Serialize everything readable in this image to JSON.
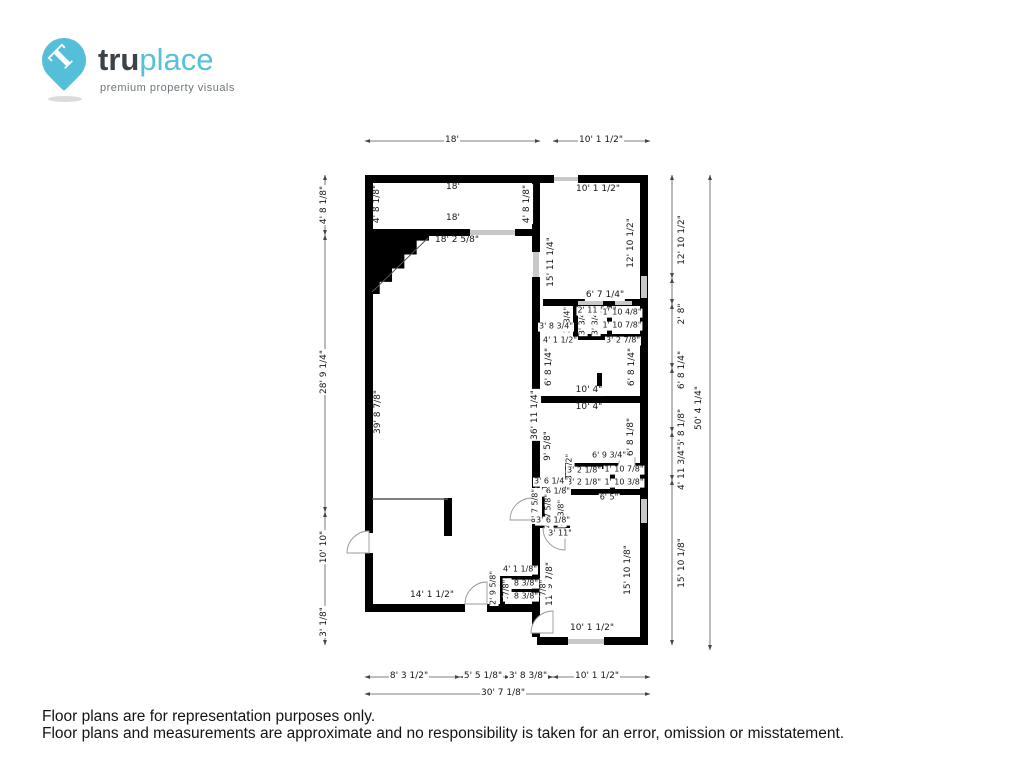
{
  "logo": {
    "brand_prefix": "tru",
    "brand_suffix": "place",
    "tagline": "premium property visuals",
    "pin_glyph": "T"
  },
  "colors": {
    "accent_blue": "#55bed8",
    "brand_dark": "#3b4248",
    "wall_black": "#000000",
    "window_gray": "#c8c8c8",
    "dimension_line": "#555555"
  },
  "footer": {
    "line1": "Floor plans are for representation purposes only.",
    "line2": "Floor plans and measurements are approximate and no responsibility is taken for an error, omission or misstatement."
  },
  "floorplan": {
    "dimension_labels": [
      {
        "text": "18'",
        "x": 452,
        "y": 141,
        "rot": 0,
        "s": 9
      },
      {
        "text": "10' 1 1/2\"",
        "x": 601,
        "y": 141,
        "rot": 0,
        "s": 9
      },
      {
        "text": "4' 8 1/8\"",
        "x": 325,
        "y": 205,
        "rot": -90,
        "s": 9
      },
      {
        "text": "28' 9 1/4\"",
        "x": 325,
        "y": 372,
        "rot": -90,
        "s": 9
      },
      {
        "text": "10' 10\"",
        "x": 325,
        "y": 547,
        "rot": -90,
        "s": 9
      },
      {
        "text": "3' 1/8\"",
        "x": 325,
        "y": 622,
        "rot": -90,
        "s": 9
      },
      {
        "text": "12' 10 1/2\"",
        "x": 683,
        "y": 240,
        "rot": -90,
        "s": 9
      },
      {
        "text": "2' 8\"",
        "x": 683,
        "y": 314,
        "rot": -90,
        "s": 9
      },
      {
        "text": "6' 8 1/4\"",
        "x": 683,
        "y": 370,
        "rot": -90,
        "s": 9
      },
      {
        "text": "6' 8 1/8\"",
        "x": 683,
        "y": 428,
        "rot": -90,
        "s": 9
      },
      {
        "text": "4' 11 3/4\"",
        "x": 683,
        "y": 468,
        "rot": -90,
        "s": 9
      },
      {
        "text": "15' 10 1/8\"",
        "x": 683,
        "y": 563,
        "rot": -90,
        "s": 9
      },
      {
        "text": "50' 4 1/4\"",
        "x": 700,
        "y": 408,
        "rot": -90,
        "s": 9
      },
      {
        "text": "8' 3 1/2\"",
        "x": 409,
        "y": 677,
        "rot": 0,
        "s": 9
      },
      {
        "text": "5' 5 1/8\"",
        "x": 483,
        "y": 677,
        "rot": 0,
        "s": 9
      },
      {
        "text": "3' 8 3/8\"",
        "x": 528,
        "y": 677,
        "rot": 0,
        "s": 9
      },
      {
        "text": "10' 1 1/2\"",
        "x": 597,
        "y": 677,
        "rot": 0,
        "s": 9
      },
      {
        "text": "30' 7 1/8\"",
        "x": 503,
        "y": 694,
        "rot": 0,
        "s": 9
      },
      {
        "text": "18'",
        "x": 453,
        "y": 188,
        "rot": 0,
        "s": 9
      },
      {
        "text": "4' 8 1/8\"",
        "x": 378,
        "y": 204,
        "rot": -90,
        "s": 9
      },
      {
        "text": "4' 8 1/8\"",
        "x": 528,
        "y": 204,
        "rot": -90,
        "s": 9
      },
      {
        "text": "18'",
        "x": 453,
        "y": 219,
        "rot": 0,
        "s": 9
      },
      {
        "text": "18' 2 5/8\"",
        "x": 457,
        "y": 241,
        "rot": 0,
        "s": 9
      },
      {
        "text": "10' 1 1/2\"",
        "x": 598,
        "y": 190,
        "rot": 0,
        "s": 9
      },
      {
        "text": "12' 10 1/2\"",
        "x": 632,
        "y": 243,
        "rot": -90,
        "s": 9
      },
      {
        "text": "15' 11 1/4\"",
        "x": 552,
        "y": 262,
        "rot": -90,
        "s": 9
      },
      {
        "text": "6' 7 1/4\"",
        "x": 605,
        "y": 296,
        "rot": 0,
        "s": 9
      },
      {
        "text": "3' 3/4\"",
        "x": 568,
        "y": 320,
        "rot": -90,
        "s": 8
      },
      {
        "text": "3' 3/4\"",
        "x": 583,
        "y": 322,
        "rot": -90,
        "s": 8
      },
      {
        "text": "3' 3/4\"",
        "x": 596,
        "y": 322,
        "rot": -90,
        "s": 8
      },
      {
        "text": "2' 11 5/8\"",
        "x": 597,
        "y": 311,
        "rot": 0,
        "s": 8
      },
      {
        "text": "1' 10 4/8\"",
        "x": 622,
        "y": 313,
        "rot": 0,
        "s": 8
      },
      {
        "text": "1' 10 7/8\"",
        "x": 622,
        "y": 326,
        "rot": 0,
        "s": 8
      },
      {
        "text": "3' 8 3/4\"",
        "x": 556,
        "y": 327,
        "rot": 0,
        "s": 8
      },
      {
        "text": "4' 1 1/2\"",
        "x": 560,
        "y": 341,
        "rot": 0,
        "s": 8
      },
      {
        "text": "3' 2 7/8\"",
        "x": 623,
        "y": 341,
        "rot": 0,
        "s": 8
      },
      {
        "text": "6' 8 1/4\"",
        "x": 550,
        "y": 367,
        "rot": -90,
        "s": 9
      },
      {
        "text": "6' 8 1/4\"",
        "x": 633,
        "y": 367,
        "rot": -90,
        "s": 9
      },
      {
        "text": "10' 4\"",
        "x": 589,
        "y": 391,
        "rot": 0,
        "s": 9
      },
      {
        "text": "10' 4\"",
        "x": 589,
        "y": 408,
        "rot": 0,
        "s": 9
      },
      {
        "text": "36' 11 1/4\"",
        "x": 536,
        "y": 415,
        "rot": -90,
        "s": 9
      },
      {
        "text": "9' 5/8\"",
        "x": 549,
        "y": 446,
        "rot": -90,
        "s": 9
      },
      {
        "text": "6' 8 1/8\"",
        "x": 632,
        "y": 437,
        "rot": -90,
        "s": 9
      },
      {
        "text": "6' 9 3/4\"",
        "x": 609,
        "y": 456,
        "rot": 0,
        "s": 8
      },
      {
        "text": "3' 1/2\"",
        "x": 570,
        "y": 467,
        "rot": -90,
        "s": 8
      },
      {
        "text": "3' 2 1/8\"",
        "x": 584,
        "y": 471,
        "rot": 0,
        "s": 8
      },
      {
        "text": "1' 10 7/8\"",
        "x": 624,
        "y": 470,
        "rot": 0,
        "s": 8
      },
      {
        "text": "3' 2 1/8\"",
        "x": 584,
        "y": 483,
        "rot": 0,
        "s": 8
      },
      {
        "text": "1' 10 3/8\"",
        "x": 624,
        "y": 483,
        "rot": 0,
        "s": 8
      },
      {
        "text": "3' 6 1/4\"",
        "x": 551,
        "y": 482,
        "rot": 0,
        "s": 8
      },
      {
        "text": "6' 5\"",
        "x": 609,
        "y": 498,
        "rot": 0,
        "s": 8
      },
      {
        "text": "3' 6 1/8\"",
        "x": 553,
        "y": 492,
        "rot": 0,
        "s": 8
      },
      {
        "text": "8' 7 5/8\"",
        "x": 536,
        "y": 506,
        "rot": -90,
        "s": 8
      },
      {
        "text": "4' 7 5/8\"",
        "x": 549,
        "y": 511,
        "rot": -90,
        "s": 8
      },
      {
        "text": "4' 3/8\"",
        "x": 562,
        "y": 513,
        "rot": -90,
        "s": 8
      },
      {
        "text": "3' 6 1/8\"",
        "x": 553,
        "y": 521,
        "rot": 0,
        "s": 8
      },
      {
        "text": "3' 11\"",
        "x": 560,
        "y": 534,
        "rot": 0,
        "s": 8
      },
      {
        "text": "11' 9 7/8\"",
        "x": 551,
        "y": 584,
        "rot": -90,
        "s": 9
      },
      {
        "text": "15' 10 1/8\"",
        "x": 629,
        "y": 570,
        "rot": -90,
        "s": 9
      },
      {
        "text": "10' 1 1/2\"",
        "x": 592,
        "y": 629,
        "rot": 0,
        "s": 9
      },
      {
        "text": "39' 8 7/8\"",
        "x": 379,
        "y": 412,
        "rot": -90,
        "s": 9
      },
      {
        "text": "14' 1 1/2\"",
        "x": 432,
        "y": 596,
        "rot": 0,
        "s": 9
      },
      {
        "text": "4' 1 1/8\"",
        "x": 520,
        "y": 570,
        "rot": 0,
        "s": 8
      },
      {
        "text": "2' 9 5/8\"",
        "x": 494,
        "y": 588,
        "rot": -90,
        "s": 8
      },
      {
        "text": "4' 8 3/8\"",
        "x": 521,
        "y": 584,
        "rot": 0,
        "s": 8
      },
      {
        "text": "4' 8 3/8\"",
        "x": 521,
        "y": 597,
        "rot": 0,
        "s": 8
      },
      {
        "text": "7/8\"",
        "x": 507,
        "y": 588,
        "rot": -90,
        "s": 8
      },
      {
        "text": "7/8\"",
        "x": 544,
        "y": 588,
        "rot": -90,
        "s": 8
      }
    ]
  }
}
